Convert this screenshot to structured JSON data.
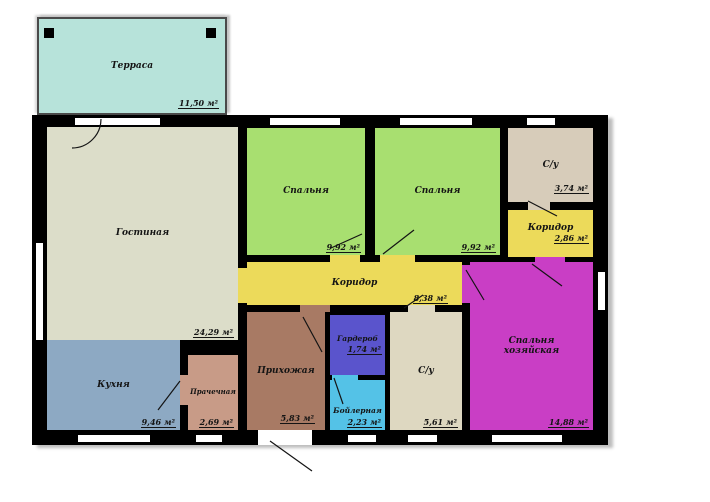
{
  "plan": {
    "type": "floor-plan",
    "rooms": [
      {
        "id": "terrace",
        "label": "Терраса",
        "area": "11,50 м²",
        "color": "#b7e3da"
      },
      {
        "id": "living",
        "label": "Гостиная",
        "area": "24,29 м²",
        "color": "#dcddc9"
      },
      {
        "id": "bedroom-1",
        "label": "Спальня",
        "area": "9,92 м²",
        "color": "#a8df70"
      },
      {
        "id": "bedroom-2",
        "label": "Спальня",
        "area": "9,92 м²",
        "color": "#a8df70"
      },
      {
        "id": "bathroom-top",
        "label": "С/у",
        "area": "3,74 м²",
        "color": "#d7ccba"
      },
      {
        "id": "corridor-small",
        "label": "Коридор",
        "area": "2,86 м²",
        "color": "#ecda5a"
      },
      {
        "id": "corridor-main",
        "label": "Коридор",
        "area": "8,38 м²",
        "color": "#ecda5a"
      },
      {
        "id": "kitchen",
        "label": "Кухня",
        "area": "9,46 м²",
        "color": "#8da9c3"
      },
      {
        "id": "laundry",
        "label": "Прачечная",
        "area": "2,69 м²",
        "color": "#c89b87"
      },
      {
        "id": "hallway",
        "label": "Прихожая",
        "area": "5,83 м²",
        "color": "#a87a64"
      },
      {
        "id": "wardrobe",
        "label": "Гардероб",
        "area": "1,74 м²",
        "color": "#5a54cc"
      },
      {
        "id": "boiler",
        "label": "Бойлерная",
        "area": "2,23 м²",
        "color": "#54c2e7"
      },
      {
        "id": "bathroom-bottom",
        "label": "С/у",
        "area": "5,61 м²",
        "color": "#ded8c1"
      },
      {
        "id": "master-bedroom",
        "label": "Спальня хозяйская",
        "area": "14,88 м²",
        "color": "#c93ec5"
      }
    ],
    "wall_color": "#000000"
  }
}
